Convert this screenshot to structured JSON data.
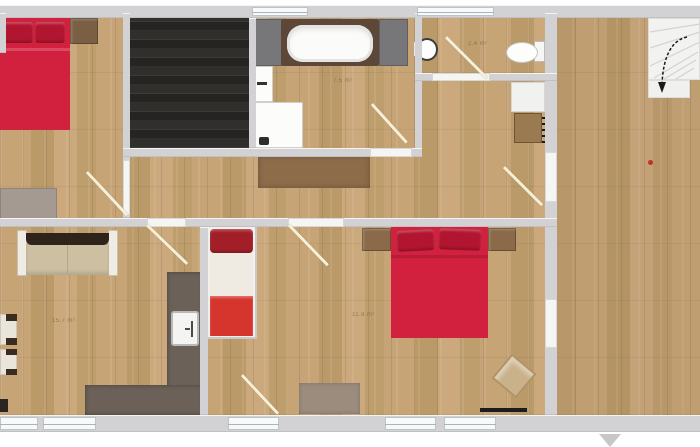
{
  "plan": {
    "type": "floor-plan-top-view",
    "labels": {
      "living_room_area": "15.7 m²",
      "bathroom_area": "7.5 m²",
      "wc_area": "2.4 m²",
      "bedroom_area": "11.8 m²"
    },
    "colors": {
      "wood_light": "#c3a171",
      "dark_room_floor": "#2c2a28",
      "wall_gray": "#d2d2d4",
      "bed_red": "#d2203f",
      "pillow_red": "#b2152f",
      "kitchen_counter_gray": "#6c6158",
      "cabinet_brown": "#9a7a50",
      "stairs_white": "#f2f2f0",
      "door_swing": "#f6efd8"
    },
    "furniture": [
      "double-bed-top-left",
      "nightstand",
      "dresser",
      "bathtub",
      "bathroom-sink",
      "washing-machine",
      "wall-sink",
      "toilet",
      "white-cabinet",
      "brown-cabinet-radiator",
      "hall-sideboard",
      "sofa",
      "armchair",
      "armchair",
      "kitchen-counter",
      "oven",
      "single-bed",
      "double-bed-right",
      "nightstand",
      "nightstand",
      "rug",
      "corner-chair",
      "radiator",
      "stairs",
      "entrance-marker"
    ]
  }
}
